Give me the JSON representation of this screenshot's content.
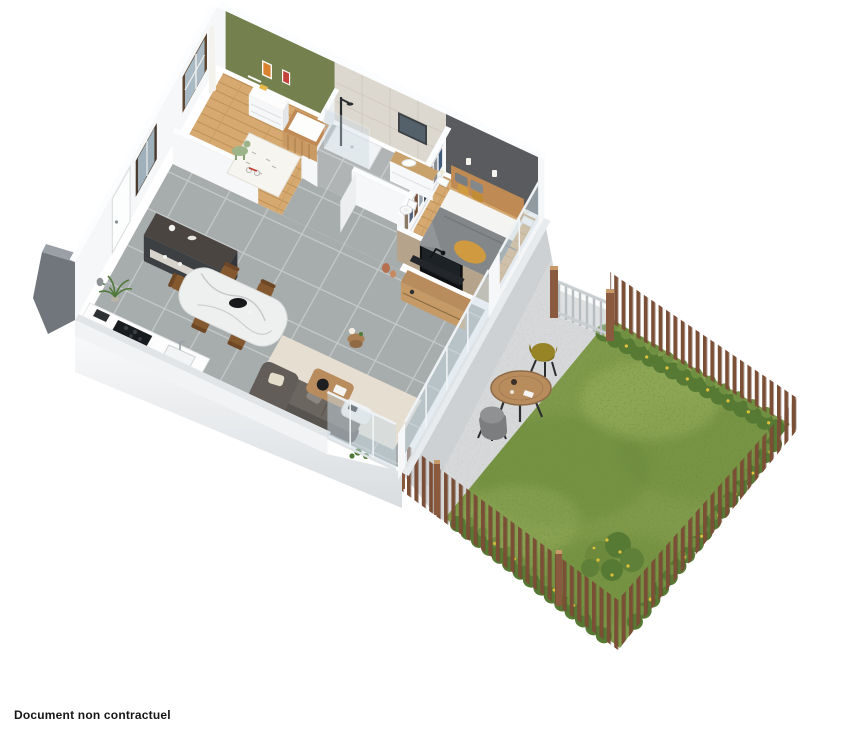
{
  "caption": "Document non contractuel",
  "colors": {
    "wallWhite": "#f6f7f8",
    "wallShade": "#eceef0",
    "wallTop": "#fcfdfe",
    "greenWall": "#74814f",
    "darkWall": "#595b5e",
    "taupeWall": "#b5a48b",
    "bathTileWall": "#ddd8cf",
    "tileFloor": "#a7acad",
    "tileGrout": "#c6cacb",
    "woodFloor": "#d5a96f",
    "woodLine": "#bb8f57",
    "lawn": "#7f9a4a",
    "lawnDark": "#6d8a3c",
    "bush": "#567934",
    "bushLight": "#6f8f41",
    "flowerYellow": "#e0c23a",
    "fence": "#7b4e36",
    "fencePost": "#8a5a3e",
    "terrace": "#d6d8d9",
    "glass": "#c9dae4",
    "exteriorGray": "#70767c",
    "marble": "#eef0ef",
    "woodFurn": "#b98c5e",
    "woodDark": "#84592f",
    "charcoal": "#3d4043",
    "sofa": "#6b6660",
    "rug": "#e9e2d3",
    "duvet": "#83878a",
    "mustard": "#d09a40",
    "bedWood": "#c08a54",
    "tv": "#0e1012",
    "oliveChair": "#968426",
    "grayChair": "#8f9192"
  }
}
